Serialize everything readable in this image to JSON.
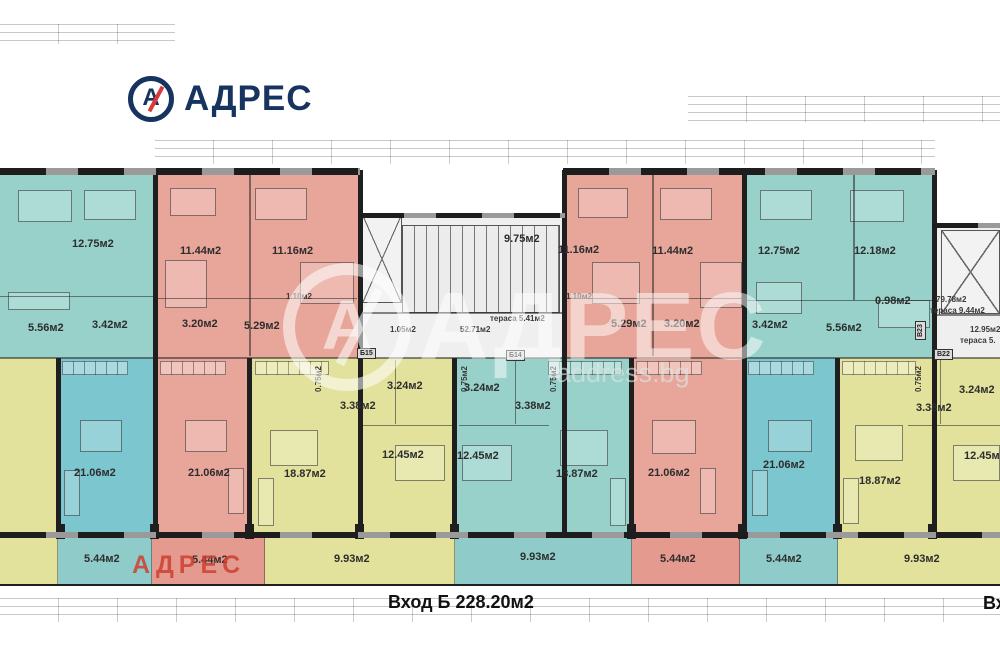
{
  "brand": {
    "logo_text": "АДРЕС"
  },
  "watermarks": {
    "big_text": "АДРЕС",
    "site_text": "address.bg",
    "red_text": "АДРЕС",
    "mark_letter": "А"
  },
  "footer": {
    "entrance_label": "Вход Б 228.20м2",
    "entrance_right_partial": "Вх"
  },
  "colors": {
    "teal": "#97d1ca",
    "teal_living": "#7cc6cf",
    "salmon": "#e8a69a",
    "yellow": "#e2e29c",
    "wall": "#1f1f1f",
    "logo_navy": "#17335f",
    "logo_red": "#d93a3a",
    "watermark_red": "#cd3e30"
  },
  "rooms": [
    {
      "name": "bedroom-clipped-left",
      "label": "12.18м2"
    },
    {
      "name": "bedroom",
      "label": "12.75м2"
    },
    {
      "name": "hallway",
      "label": "5.56м2"
    },
    {
      "name": "bathroom",
      "label": "3.42м2"
    },
    {
      "name": "wc-clipped-left",
      "label": "0.98м2"
    },
    {
      "name": "bedroom",
      "label": "11.44м2"
    },
    {
      "name": "bedroom",
      "label": "11.16м2"
    },
    {
      "name": "wc",
      "label": "1.10м2"
    },
    {
      "name": "bathroom",
      "label": "3.20м2"
    },
    {
      "name": "hallway",
      "label": "5.29м2"
    },
    {
      "name": "stairwell",
      "label": "9.75м2"
    },
    {
      "name": "bedroom",
      "label": "11.16м2"
    },
    {
      "name": "bedroom",
      "label": "11.44м2"
    },
    {
      "name": "wc",
      "label": "1.10м2"
    },
    {
      "name": "hallway",
      "label": "5.29м2"
    },
    {
      "name": "bathroom",
      "label": "3.20м2"
    },
    {
      "name": "bedroom",
      "label": "12.75м2"
    },
    {
      "name": "bedroom",
      "label": "12.18м2"
    },
    {
      "name": "bathroom",
      "label": "3.42м2"
    },
    {
      "name": "hallway",
      "label": "5.56м2"
    },
    {
      "name": "wc",
      "label": "0.98м2"
    },
    {
      "name": "living-clipped-left",
      "label": "18.87м2"
    },
    {
      "name": "living",
      "label": "21.06м2"
    },
    {
      "name": "living",
      "label": "21.06м2"
    },
    {
      "name": "wc",
      "label": "3.24м2"
    },
    {
      "name": "bathroom",
      "label": "3.38м2"
    },
    {
      "name": "bedroom",
      "label": "12.45м2"
    },
    {
      "name": "living",
      "label": "18.87м2"
    },
    {
      "name": "wc",
      "label": "3.24м2"
    },
    {
      "name": "bathroom",
      "label": "3.38м2"
    },
    {
      "name": "bedroom",
      "label": "12.45м2"
    },
    {
      "name": "living",
      "label": "18.87м2"
    },
    {
      "name": "living",
      "label": "21.06м2"
    },
    {
      "name": "living",
      "label": "21.06м2"
    },
    {
      "name": "bathroom",
      "label": "3.38м2"
    },
    {
      "name": "wc-clipped-right",
      "label": "3.24м2"
    },
    {
      "name": "bedroom-clipped-right",
      "label": "12.45м2"
    },
    {
      "name": "living",
      "label": "18.87м2"
    },
    {
      "name": "shaft",
      "label": "0.75м2"
    },
    {
      "name": "shaft",
      "label": "0.75м2"
    },
    {
      "name": "shaft",
      "label": "0.75м2"
    },
    {
      "name": "shaft",
      "label": "0.75м2"
    }
  ],
  "terraces": [
    {
      "name": "terrace",
      "label": "5.44м2"
    },
    {
      "name": "terrace",
      "label": "5.44м2"
    },
    {
      "name": "terrace",
      "label": "9.93м2"
    },
    {
      "name": "terrace",
      "label": "9.93м2"
    },
    {
      "name": "terrace",
      "label": "5.44м2"
    },
    {
      "name": "terrace",
      "label": "5.44м2"
    },
    {
      "name": "terrace",
      "label": "9.93м2"
    }
  ],
  "core_left_notes": [
    "1.05м2",
    "52.71м2",
    "тераса 5.41м2"
  ],
  "core_right_notes": [
    "79.78м2",
    "тераса 9.44м2",
    "12.95м2",
    "тераса 5."
  ],
  "door_labels": [
    {
      "name": "door-b15",
      "label": "Б15"
    },
    {
      "name": "door-b14",
      "label": "Б14"
    },
    {
      "name": "door-v22",
      "label": "В22"
    },
    {
      "name": "door-v23",
      "label": "В23"
    }
  ]
}
